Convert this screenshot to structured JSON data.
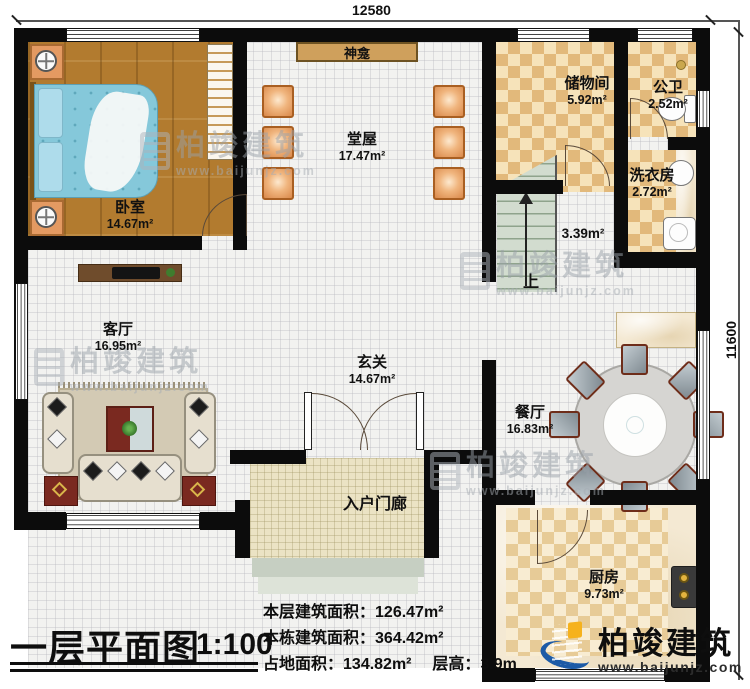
{
  "dimensions": {
    "width": "12580",
    "height": "11600"
  },
  "rooms": {
    "bedroom": {
      "name": "卧室",
      "area": "14.67m²"
    },
    "hall": {
      "name": "堂屋",
      "area": "17.47m²"
    },
    "shrine": {
      "name": "神龛"
    },
    "storage": {
      "name": "储物间",
      "area": "5.92m²"
    },
    "bathroom": {
      "name": "公卫",
      "area": "2.52m²"
    },
    "laundry": {
      "name": "洗衣房",
      "area": "2.72m²"
    },
    "living": {
      "name": "客厅",
      "area": "16.95m²"
    },
    "foyer": {
      "name": "玄关",
      "area": "14.67m²"
    },
    "dining": {
      "name": "餐厅",
      "area": "16.83m²"
    },
    "kitchen": {
      "name": "厨房",
      "area": "9.73m²"
    },
    "porch": {
      "name": "入户门廊"
    },
    "stairwell": {
      "area": "3.39m²",
      "direction": "上"
    }
  },
  "title_block": {
    "title": "一层平面图",
    "scale": "1:100"
  },
  "stats": [
    {
      "label": "本层建筑面积：",
      "value": "126.47m²"
    },
    {
      "label": "本栋建筑面积：",
      "value": "364.42m²"
    },
    {
      "label": "占地面积：",
      "value": "134.82m²"
    },
    {
      "label": "层高：",
      "value": "3.9m"
    }
  ],
  "brand": {
    "name": "柏竣建筑",
    "url": "www.baijunjz.com"
  },
  "watermark": {
    "name": "柏竣建筑",
    "url": "www.baijunjz.com"
  },
  "colors": {
    "wall": "#0c0c0c",
    "checker": "#e2b97b",
    "wood": "#b27b2f",
    "stair": "#ccd8ca",
    "brand_blue": "#1c5aa6",
    "brand_orange": "#f6b21d"
  }
}
